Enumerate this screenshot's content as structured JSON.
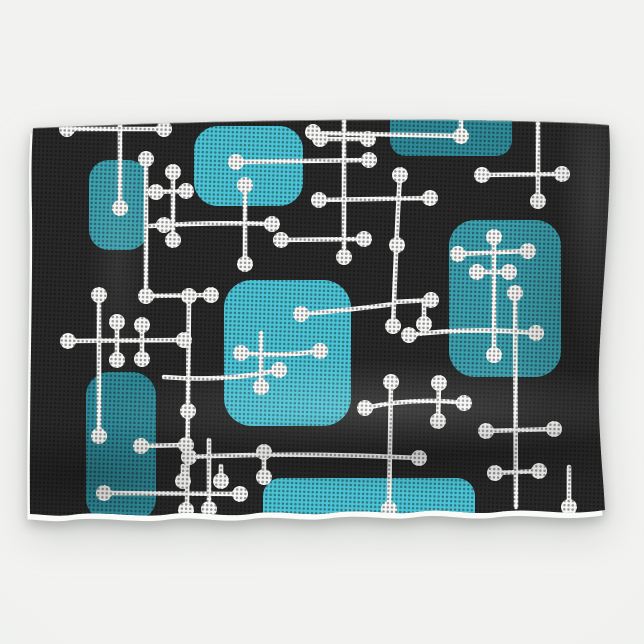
{
  "meta": {
    "subject": "Product photo of a hanging kitchen towel printed with a retro mid-century modern atomic-era pattern",
    "background_center": "#f2f3f1",
    "background_edge": "#e9ebea"
  },
  "towel": {
    "fabric_color": "#282828",
    "hem_color": "#fafaf8",
    "texture_dot_color": "#0c0c0c",
    "outline_path": "M33,128 C140,123 320,118 460,120 C520,121 580,122 609,125 C613,185 602,290 599,360 C597,425 603,470 605,510 C560,517 535,507 498,512 C468,516 446,507 416,512 C391,516 369,508 331,513 C303,517 279,509 251,514 C223,518 199,510 171,514 C141,519 101,510 71,515 C56,517 38,514 30,514 C29,420 33,280 32,210 C31,165 32,143 33,128 Z"
  },
  "pattern": {
    "line_color": "#f6f7f5",
    "line_width": 4.6,
    "dot_radius": 8,
    "square_colors": {
      "bright": "#4AC4D6",
      "medium": "#3BA0AF",
      "dark": "#2E8A99"
    },
    "squares": [
      {
        "x": 89,
        "y": 160,
        "w": 59,
        "h": 90,
        "r": 20,
        "tone": "medium"
      },
      {
        "x": 194,
        "y": 126,
        "w": 109,
        "h": 80,
        "r": 24,
        "tone": "bright"
      },
      {
        "x": 390,
        "y": 108,
        "w": 122,
        "h": 48,
        "r": 16,
        "tone": "dark"
      },
      {
        "x": 449,
        "y": 220,
        "w": 112,
        "h": 157,
        "r": 26,
        "tone": "medium"
      },
      {
        "x": 224,
        "y": 280,
        "w": 127,
        "h": 146,
        "r": 28,
        "tone": "bright"
      },
      {
        "x": 86,
        "y": 372,
        "w": 70,
        "h": 150,
        "r": 24,
        "tone": "dark"
      },
      {
        "x": 263,
        "y": 478,
        "w": 212,
        "h": 55,
        "r": 18,
        "tone": "bright"
      }
    ],
    "lines": [
      "M62,129 L164,129",
      "M120,124 L120,208",
      "M173,170 L173,240",
      "M153,192 L187,191",
      "M150,226 Q210,222 272,224",
      "M146,159 L146,296",
      "M146,296 L211,295",
      "M236,162 L369,160",
      "M344,121 L344,257",
      "M320,139 L368,139",
      "M319,200 L430,198",
      "M281,240 L364,239",
      "M245,185 L245,264",
      "M313,133 L461,136",
      "M461,121 L461,137",
      "M538,121 L538,201",
      "M482,175 L562,174",
      "M494,237 L494,355",
      "M458,254 L528,251",
      "M477,272 L509,272",
      "M515,293 L516,507",
      "M409,335 Q470,327 536,333",
      "M486,431 L554,429",
      "M495,473 L539,471",
      "M569,467 L569,507",
      "M365,408 Q414,397 464,403",
      "M391,382 L389,509",
      "M439,383 L438,421",
      "M400,175 C397,220 395,280 393,326",
      "M394,302 L431,300",
      "M424,302 L424,324",
      "M301,314 Q350,310 394,304",
      "M261,333 L261,387",
      "M241,353 Q280,357 320,351",
      "M164,377 Q225,382 279,370",
      "M189,296 L187,510",
      "M68,341 L184,340",
      "M99,295 L99,436",
      "M117,322 L117,360",
      "M142,325 L142,359",
      "M189,457 Q300,452 419,458",
      "M264,452 L264,477",
      "M209,440 L209,509",
      "M104,493 L240,494",
      "M141,446 L186,445",
      "M183,466 L183,481",
      "M221,466 L221,481"
    ],
    "dots": [
      [
        67,
        129
      ],
      [
        164,
        129
      ],
      [
        120,
        208
      ],
      [
        173,
        172
      ],
      [
        173,
        240
      ],
      [
        156,
        192
      ],
      [
        186,
        191
      ],
      [
        164,
        225
      ],
      [
        272,
        224
      ],
      [
        146,
        159
      ],
      [
        146,
        296
      ],
      [
        211,
        295
      ],
      [
        236,
        162
      ],
      [
        369,
        160
      ],
      [
        344,
        257
      ],
      [
        320,
        139
      ],
      [
        368,
        139
      ],
      [
        319,
        200
      ],
      [
        430,
        198
      ],
      [
        281,
        240
      ],
      [
        364,
        239
      ],
      [
        245,
        185
      ],
      [
        245,
        264
      ],
      [
        313,
        132
      ],
      [
        461,
        136
      ],
      [
        538,
        201
      ],
      [
        482,
        175
      ],
      [
        562,
        174
      ],
      [
        494,
        237
      ],
      [
        494,
        355
      ],
      [
        458,
        254
      ],
      [
        528,
        251
      ],
      [
        477,
        272
      ],
      [
        509,
        272
      ],
      [
        515,
        293
      ],
      [
        409,
        335
      ],
      [
        536,
        333
      ],
      [
        486,
        431
      ],
      [
        554,
        429
      ],
      [
        495,
        473
      ],
      [
        539,
        471
      ],
      [
        569,
        507
      ],
      [
        365,
        408
      ],
      [
        464,
        403
      ],
      [
        391,
        382
      ],
      [
        389,
        509
      ],
      [
        439,
        383
      ],
      [
        438,
        421
      ],
      [
        400,
        175
      ],
      [
        397,
        245
      ],
      [
        393,
        326
      ],
      [
        431,
        300
      ],
      [
        424,
        324
      ],
      [
        301,
        314
      ],
      [
        261,
        387
      ],
      [
        241,
        353
      ],
      [
        320,
        351
      ],
      [
        279,
        370
      ],
      [
        189,
        296
      ],
      [
        188,
        411
      ],
      [
        186,
        510
      ],
      [
        68,
        341
      ],
      [
        184,
        340
      ],
      [
        99,
        295
      ],
      [
        99,
        436
      ],
      [
        117,
        322
      ],
      [
        117,
        360
      ],
      [
        142,
        325
      ],
      [
        142,
        359
      ],
      [
        189,
        457
      ],
      [
        419,
        458
      ],
      [
        264,
        452
      ],
      [
        264,
        477
      ],
      [
        209,
        509
      ],
      [
        104,
        493
      ],
      [
        240,
        494
      ],
      [
        141,
        446
      ],
      [
        186,
        445
      ],
      [
        183,
        481
      ],
      [
        221,
        481
      ]
    ]
  }
}
